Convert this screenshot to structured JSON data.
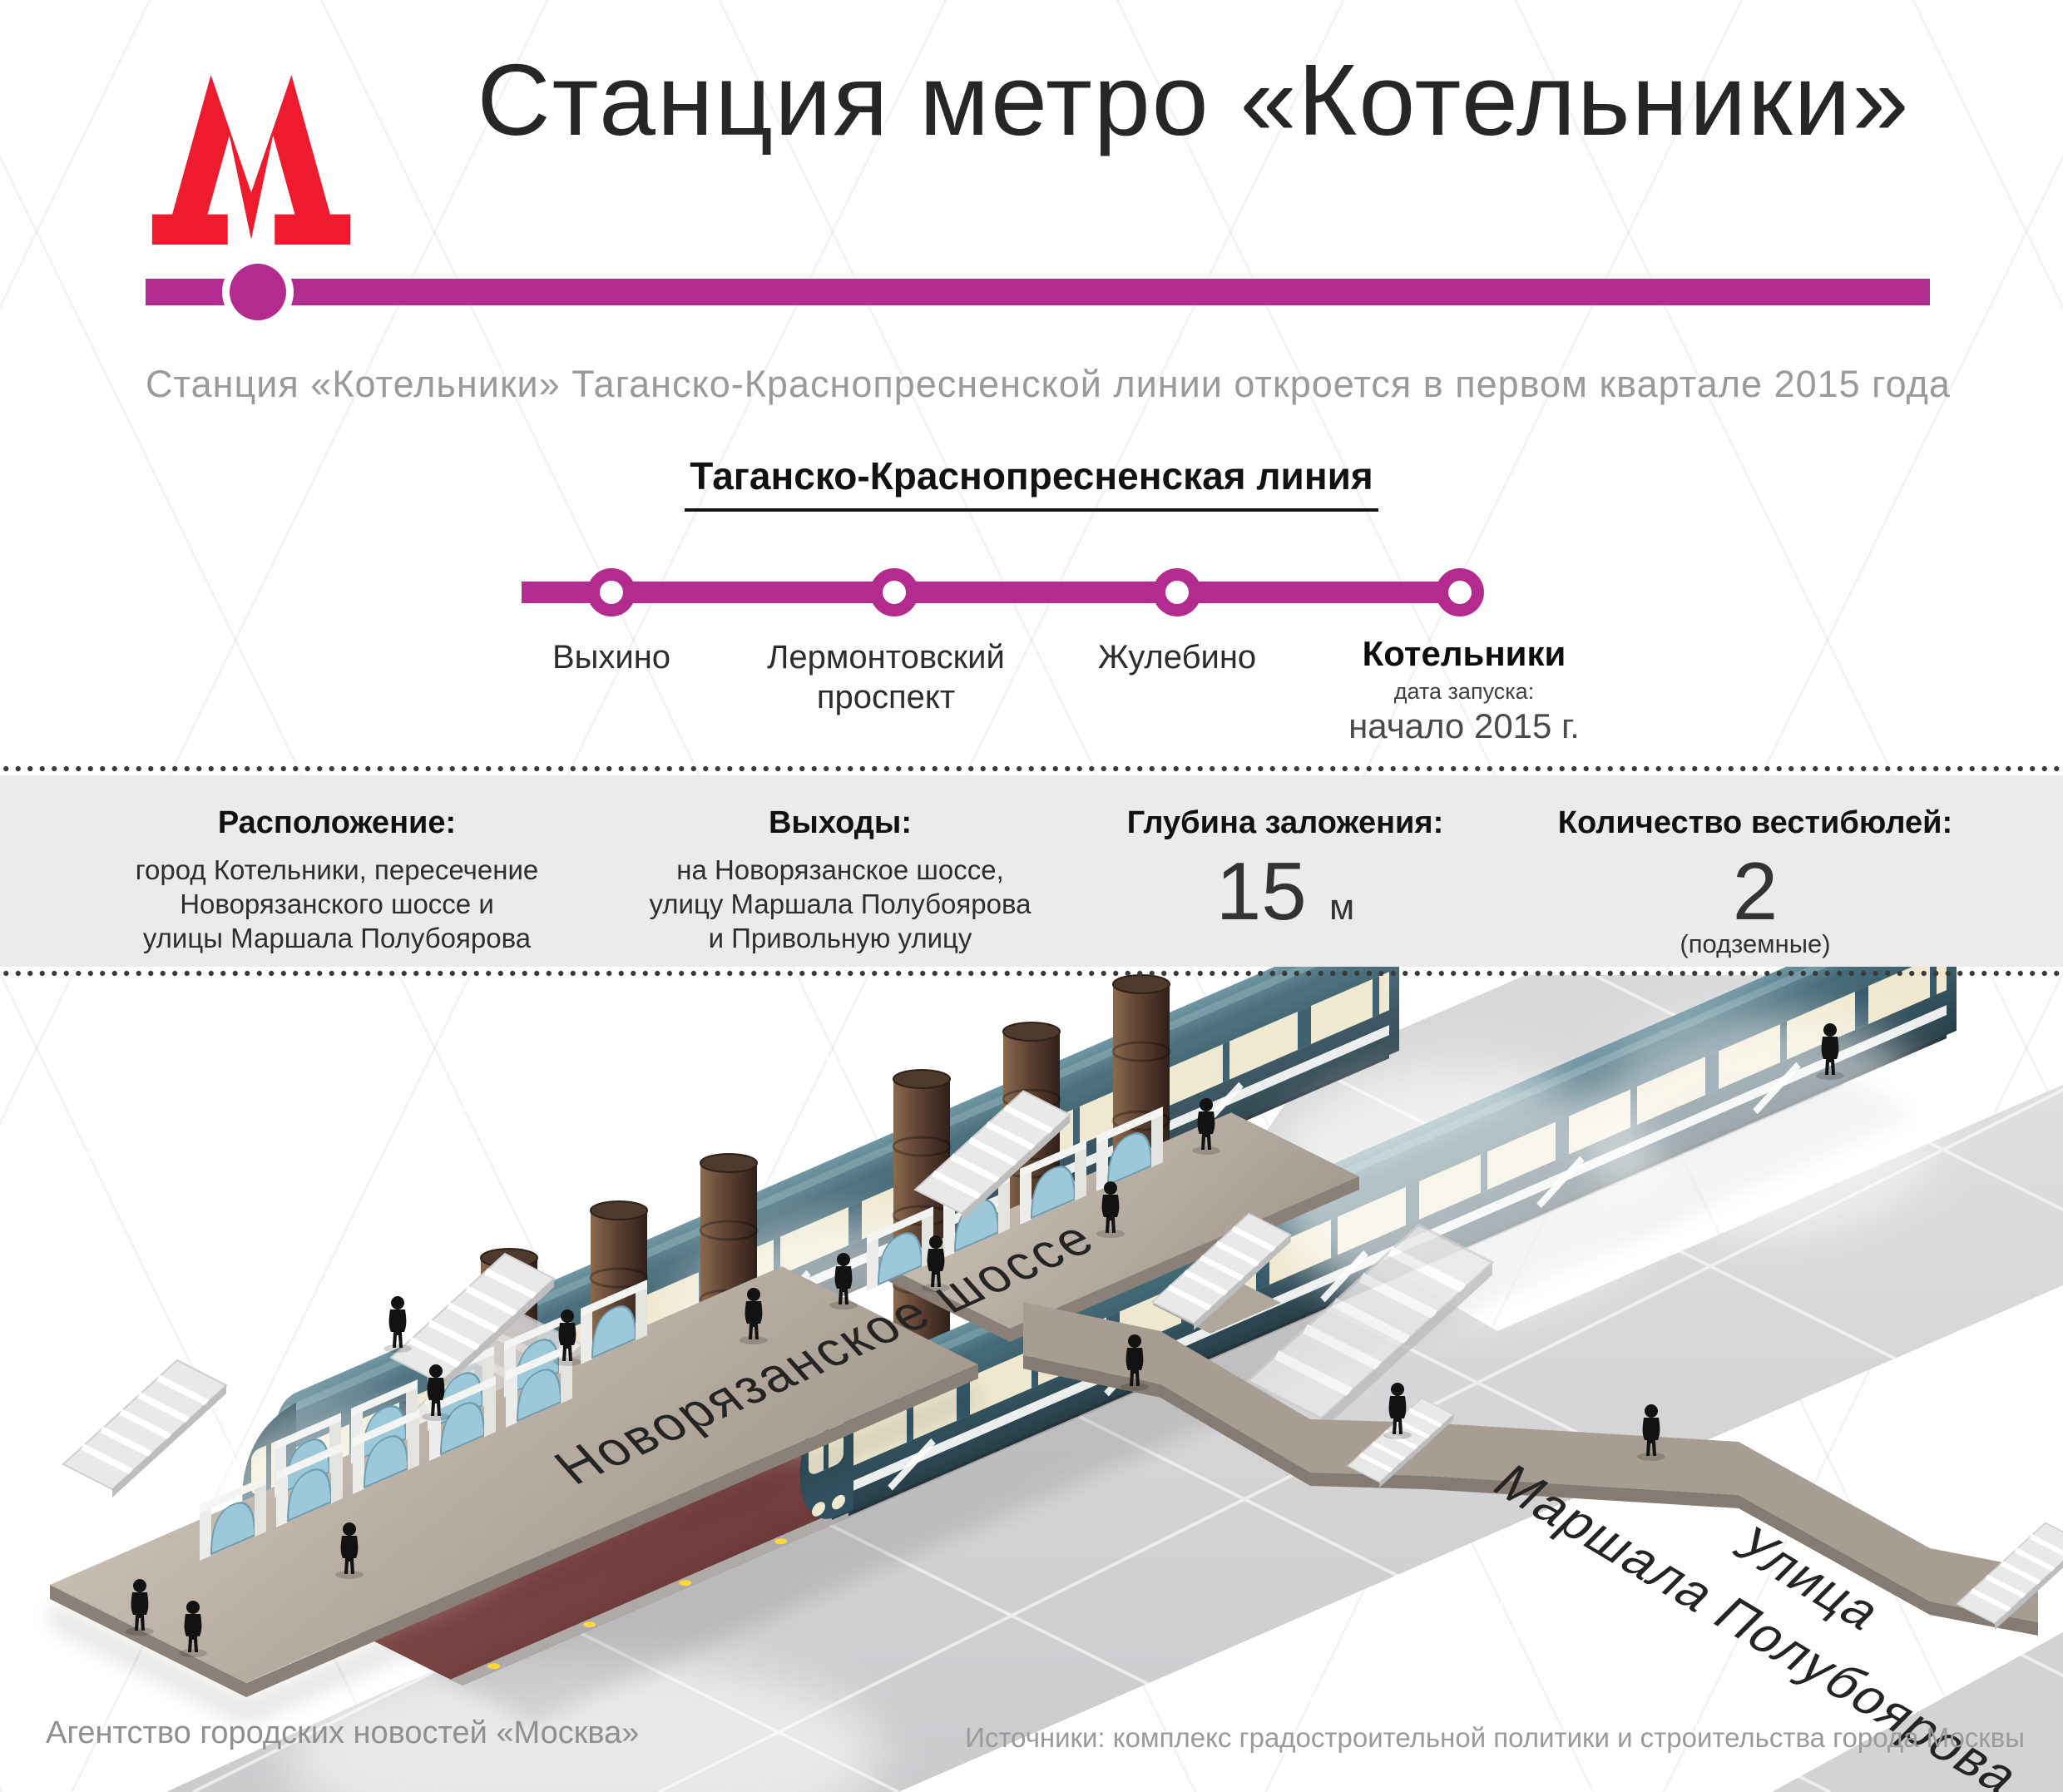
{
  "header": {
    "title": "Станция метро «Котельники»",
    "subtitle": "Станция «Котельники» Таганско-Краснопресненской линии откроется в первом квартале 2015 года"
  },
  "line_diagram": {
    "title": "Таганско-Краснопресненская линия",
    "line_color": "#b32b8e",
    "stations": [
      {
        "name": "Выхино"
      },
      {
        "name": "Лермонтовский проспект"
      },
      {
        "name": "Жулебино"
      },
      {
        "name": "Котельники",
        "launch_label": "дата запуска:",
        "launch_value": "начало 2015 г."
      }
    ]
  },
  "facts": {
    "location": {
      "label": "Расположение:",
      "lines": [
        "город Котельники, пересечение",
        "Новорязанского шоссе и",
        "улицы Маршала Полубоярова"
      ]
    },
    "exits": {
      "label": "Выходы:",
      "lines": [
        "на Новорязанское шоссе,",
        "улицу Маршала Полубоярова",
        "и Привольную улицу"
      ]
    },
    "depth": {
      "label": "Глубина заложения:",
      "value": "15",
      "unit": "м"
    },
    "vestibules": {
      "label": "Количество вестибюлей:",
      "value": "2",
      "note": "(подземные)"
    }
  },
  "illustration": {
    "street_main": "Новорязанское шоссе",
    "street_cross_line1": "Улица",
    "street_cross_line2": "Маршала Полубоярова"
  },
  "footer": {
    "credit": "Агентство городских новостей «Москва»",
    "sources": "Источники: комплекс градостроительной политики и строительства города Москвы"
  },
  "colors": {
    "line": "#b32b8e",
    "logo_red": "#ed1b2d",
    "band_gray": "#ebebeb"
  }
}
